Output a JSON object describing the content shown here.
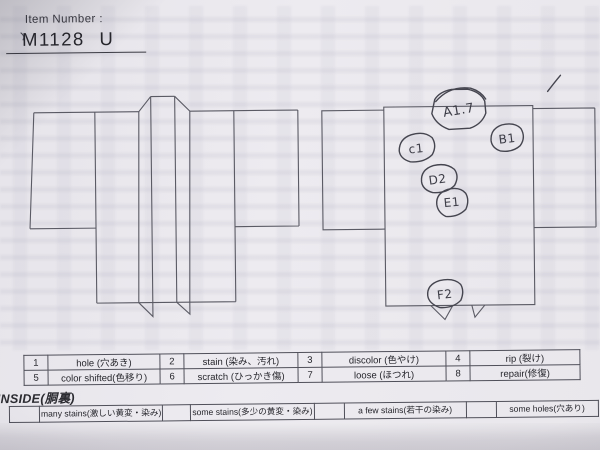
{
  "header": {
    "label": "Item Number :",
    "item_number": "M1128 U"
  },
  "annotations": [
    {
      "label": "A1.7"
    },
    {
      "label": "B1"
    },
    {
      "label": "c1"
    },
    {
      "label": "D2"
    },
    {
      "label": "E1"
    },
    {
      "label": "F2"
    }
  ],
  "defect_table": {
    "rows": [
      [
        {
          "num": "1",
          "label": "hole (穴あき)"
        },
        {
          "num": "2",
          "label": "stain (染み、汚れ)"
        },
        {
          "num": "3",
          "label": "discolor (色やけ)"
        },
        {
          "num": "4",
          "label": "rip (裂け)"
        }
      ],
      [
        {
          "num": "5",
          "label": "color shifted(色移り)"
        },
        {
          "num": "6",
          "label": "scratch (ひっかき傷)"
        },
        {
          "num": "7",
          "label": "loose (ほつれ)"
        },
        {
          "num": "8",
          "label": "repair(修復)"
        }
      ]
    ]
  },
  "inside": {
    "title": "INSIDE(胴裏)",
    "options": [
      "many stains(激しい黄変・染み)",
      "some stains(多少の黄変・染み)",
      "a few stains(若干の染み)",
      "some holes(穴あり)"
    ]
  },
  "colors": {
    "paper": "#eae8ed",
    "printed_ink": "#26262c",
    "outline_ink": "#5a5a64",
    "pen_ink": "#45454f"
  }
}
